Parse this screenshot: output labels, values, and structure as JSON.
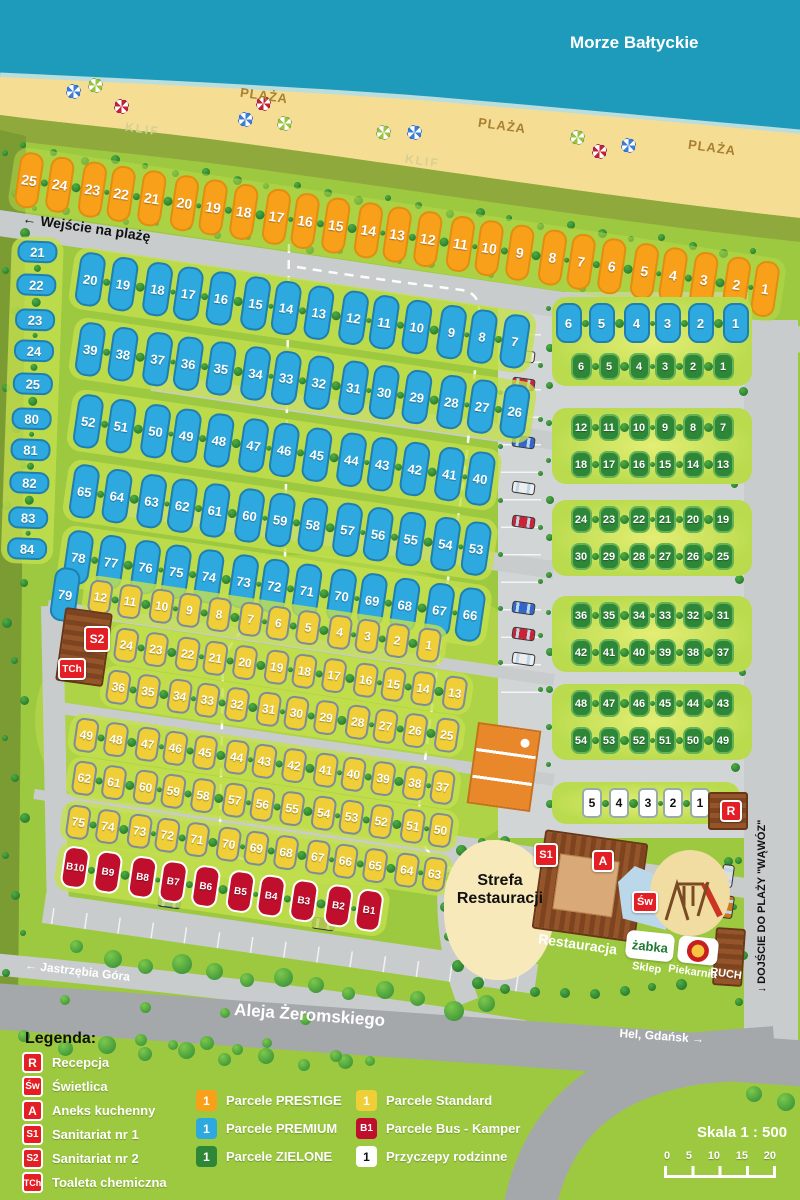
{
  "sea": {
    "label": "Morze Bałtyckie"
  },
  "beach": {
    "plaza": "PLAŻA",
    "klif": "KLIF"
  },
  "roads": {
    "beach_entrance": "← Wejście na plażę",
    "street_left": "← Jastrzębia Góra",
    "street_main": "Aleja Żeromskiego",
    "street_right": "Hel, Gdańsk →",
    "beach_access": "↓ DOJŚCIE DO PLAŻY \"WĄWÓZ\""
  },
  "parcels": {
    "prestige": [
      25,
      24,
      23,
      22,
      21,
      20,
      19,
      18,
      17,
      16,
      15,
      14,
      13,
      12,
      11,
      10,
      9,
      8,
      7,
      6,
      5,
      4,
      3,
      2,
      1
    ],
    "premium_col": [
      21,
      22,
      23,
      24,
      25,
      80,
      81,
      82,
      83,
      84
    ],
    "premium_r1": [
      20,
      19,
      18,
      17,
      16,
      15,
      14,
      13,
      12,
      11,
      10,
      9,
      8,
      7
    ],
    "premium_r2": [
      39,
      38,
      37,
      36,
      35,
      34,
      33,
      32,
      31,
      30,
      29,
      28,
      27,
      26
    ],
    "premium_r3": [
      52,
      51,
      50,
      49,
      48,
      47,
      46,
      45,
      44,
      43,
      42,
      41,
      40
    ],
    "premium_r4": [
      65,
      64,
      63,
      62,
      61,
      60,
      59,
      58,
      57,
      56,
      55,
      54,
      53
    ],
    "premium_r5": [
      78,
      77,
      76,
      75,
      74,
      73,
      72,
      71,
      70,
      69,
      68,
      67,
      66
    ],
    "premium_79": [
      79
    ],
    "premium_right": [
      6,
      5,
      4,
      3,
      2,
      1
    ],
    "zielone_g1": [
      6,
      5,
      4,
      3,
      2,
      1
    ],
    "zielone_g2a": [
      12,
      11,
      10,
      9,
      8,
      7
    ],
    "zielone_g2b": [
      18,
      17,
      16,
      15,
      14,
      13
    ],
    "zielone_g3a": [
      24,
      23,
      22,
      21,
      20,
      19
    ],
    "zielone_g3b": [
      30,
      29,
      28,
      27,
      26,
      25
    ],
    "zielone_g4a": [
      36,
      35,
      34,
      33,
      32,
      31
    ],
    "zielone_g4b": [
      42,
      41,
      40,
      39,
      38,
      37
    ],
    "zielone_g5a": [
      48,
      47,
      46,
      45,
      44,
      43
    ],
    "zielone_g5b": [
      54,
      53,
      52,
      51,
      50,
      49
    ],
    "standard_r1": [
      12,
      11,
      10,
      9,
      8,
      7,
      6,
      5,
      4,
      3,
      2,
      1
    ],
    "standard_r2": [
      24,
      23,
      22,
      21,
      20,
      19,
      18,
      17,
      16,
      15,
      14,
      13
    ],
    "standard_r3": [
      36,
      35,
      34,
      33,
      32,
      31,
      30,
      29,
      28,
      27,
      26,
      25
    ],
    "standard_r4": [
      49,
      48,
      47,
      46,
      45,
      44,
      43,
      42,
      41,
      40,
      39,
      38,
      37
    ],
    "standard_r5": [
      62,
      61,
      60,
      59,
      58,
      57,
      56,
      55,
      54,
      53,
      52,
      51,
      50
    ],
    "standard_r6": [
      75,
      74,
      73,
      72,
      71,
      70,
      69,
      68,
      67,
      66,
      65,
      64,
      63
    ],
    "bus": [
      "B10",
      "B9",
      "B8",
      "B7",
      "B6",
      "B5",
      "B4",
      "B3",
      "B2",
      "B1"
    ],
    "family": [
      5,
      4,
      3,
      2,
      1
    ]
  },
  "facilities": {
    "s2": "S2",
    "tch": "TCh",
    "s1": "S1",
    "aneks": "A",
    "swietlica": "Św",
    "recepcja": "R",
    "strefa_line1": "Strefa",
    "strefa_line2": "Restauracji",
    "restauracja": "Restauracja",
    "zabka": "żabka",
    "sklep": "Sklep",
    "piekarnia": "Piekarnia",
    "ruch": "RUCH"
  },
  "legend": {
    "title": "Legenda:",
    "facilities": [
      {
        "icon": "R",
        "label": "Recepcja"
      },
      {
        "icon": "Św",
        "label": "Świetlica"
      },
      {
        "icon": "A",
        "label": "Aneks kuchenny"
      },
      {
        "icon": "S1",
        "label": "Sanitariat nr 1"
      },
      {
        "icon": "S2",
        "label": "Sanitariat nr 2"
      },
      {
        "icon": "TCh",
        "label": "Toaleta chemiczna"
      }
    ],
    "types_col1": [
      {
        "icon": "1",
        "cls": "prestige",
        "label": "Parcele PRESTIGE"
      },
      {
        "icon": "1",
        "cls": "premium",
        "label": "Parcele PREMIUM"
      },
      {
        "icon": "1",
        "cls": "zielone",
        "label": "Parcele ZIELONE"
      }
    ],
    "types_col2": [
      {
        "icon": "1",
        "cls": "standard",
        "label": "Parcele Standard"
      },
      {
        "icon": "B1",
        "cls": "bus",
        "label": "Parcele Bus - Kamper"
      },
      {
        "icon": "1",
        "cls": "family",
        "label": "Przyczepy rodzinne"
      }
    ]
  },
  "scale": {
    "label": "Skala 1 : 500",
    "ticks": [
      "0",
      "5",
      "10",
      "15",
      "20"
    ]
  },
  "colors": {
    "prestige": "#F9A01B",
    "premium": "#2EA9DF",
    "zielone": "#2E8637",
    "standard": "#EFCE38",
    "bus": "#C00F2D",
    "icon_red": "#E31E24",
    "sea": "#1E9ABA",
    "sand": "#F5DD93",
    "grass": "#9CC93F"
  }
}
